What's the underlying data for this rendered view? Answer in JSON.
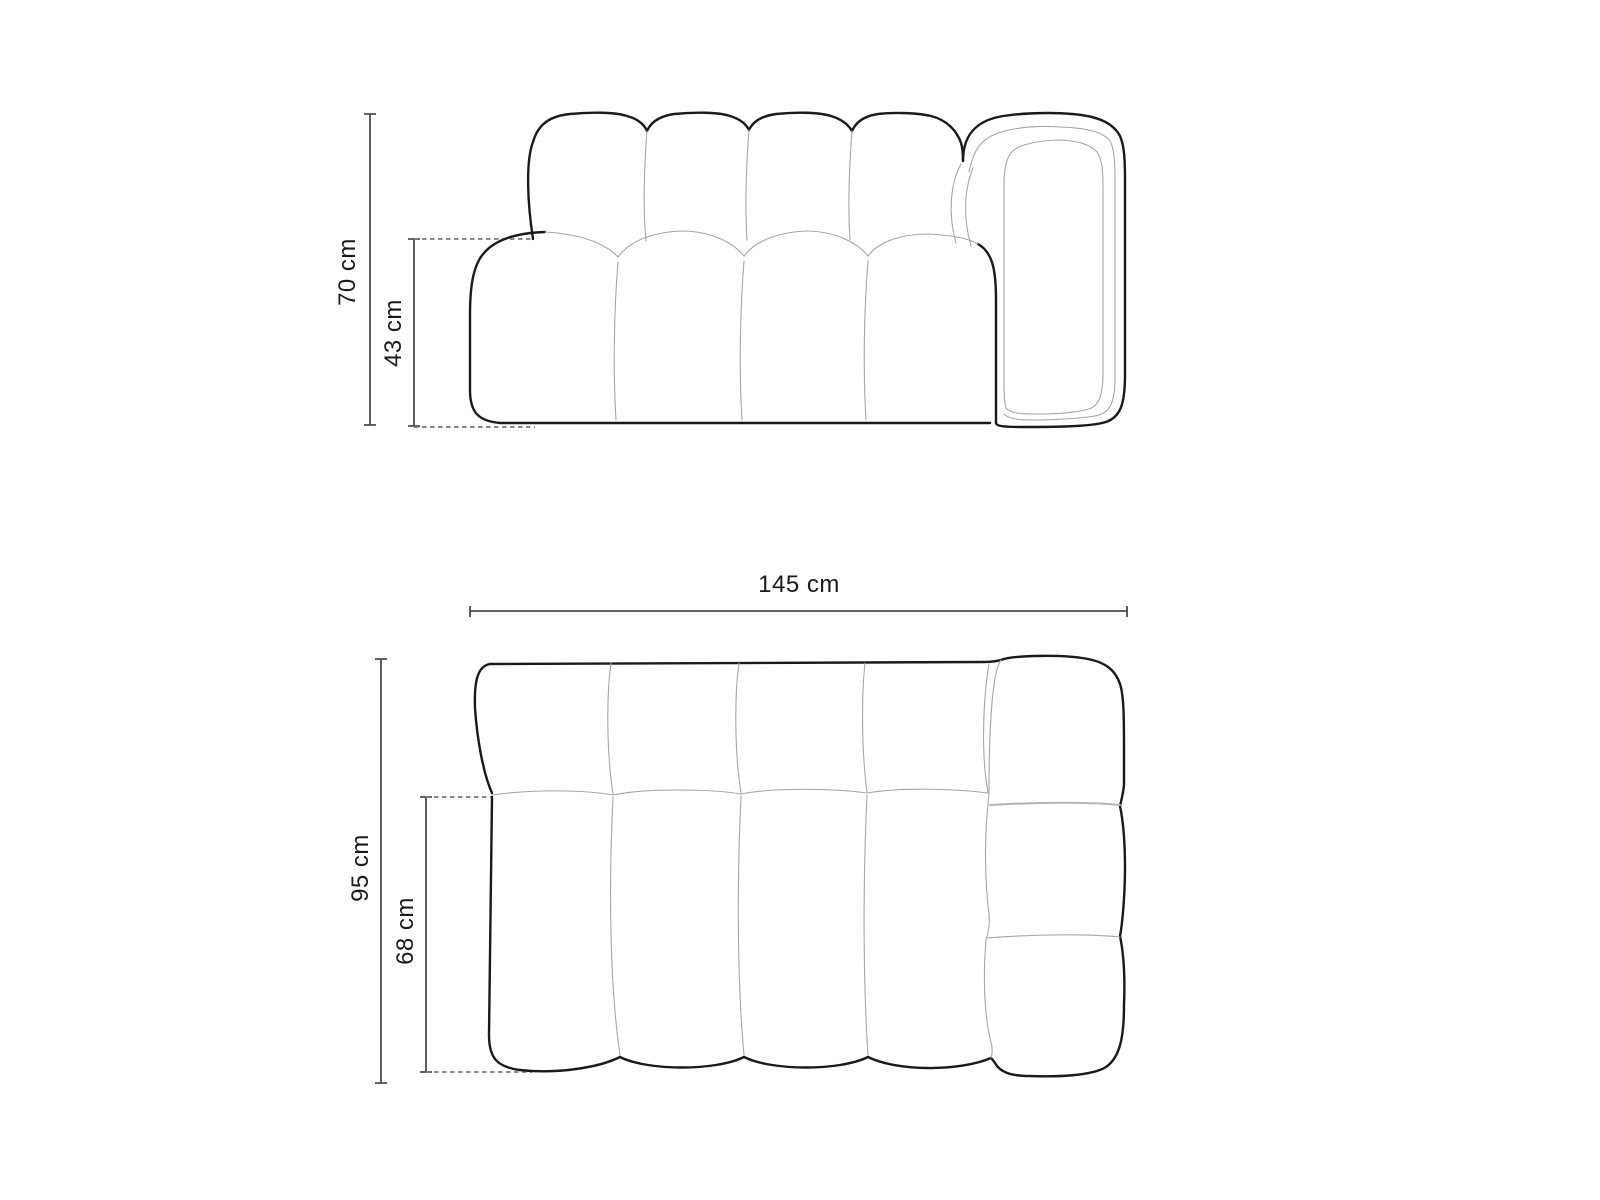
{
  "colors": {
    "background": "#ffffff",
    "outline": "#1a1a1a",
    "seam": "#a6a6a6",
    "seamStrong": "#b4b4b4",
    "dimension": "#4d4d4d",
    "dashed": "#7a7a7a",
    "label": "#1a1a1a"
  },
  "figure": {
    "subject": "modular sofa element with right armrest, line drawing",
    "back_cushions": 4,
    "seat_channels": 4,
    "armrest_segments": 3
  },
  "front_view": {
    "total_height_label": "70 cm",
    "seat_height_label": "43 cm"
  },
  "top_view": {
    "total_width_label": "145 cm",
    "total_depth_label": "95 cm",
    "seat_depth_label": "68 cm"
  }
}
